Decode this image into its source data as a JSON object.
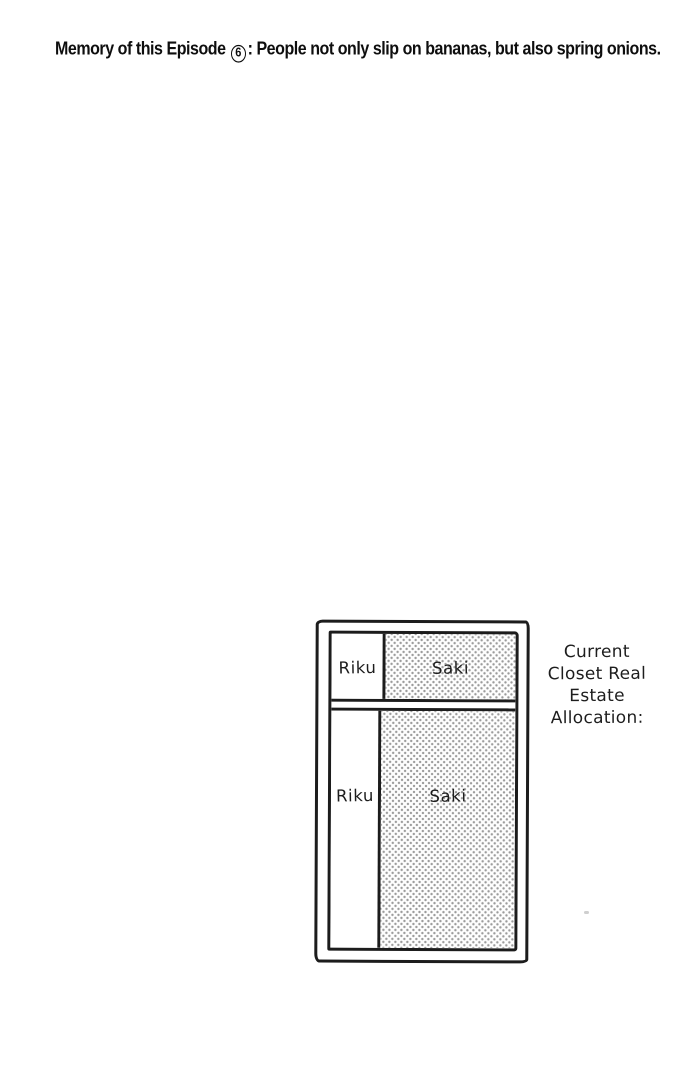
{
  "header": {
    "caption_prefix": "Memory of this Episode ",
    "episode_number": "6",
    "caption_suffix": ": People not only slip on bananas, but also spring onions."
  },
  "closet": {
    "top_shelf": {
      "left_label": "Riku",
      "right_label": "Saki"
    },
    "main_section": {
      "left_label": "Riku",
      "right_label": "Saki"
    }
  },
  "side_note": {
    "full_text": "Current Closet Real Estate Allocation:",
    "lines": [
      "Current",
      "Closet Real",
      "Estate",
      "Allocation:"
    ]
  },
  "colors": {
    "background": "#ffffff",
    "ink": "#1c1c1c",
    "screentone_dot": "#9b9b9b"
  }
}
